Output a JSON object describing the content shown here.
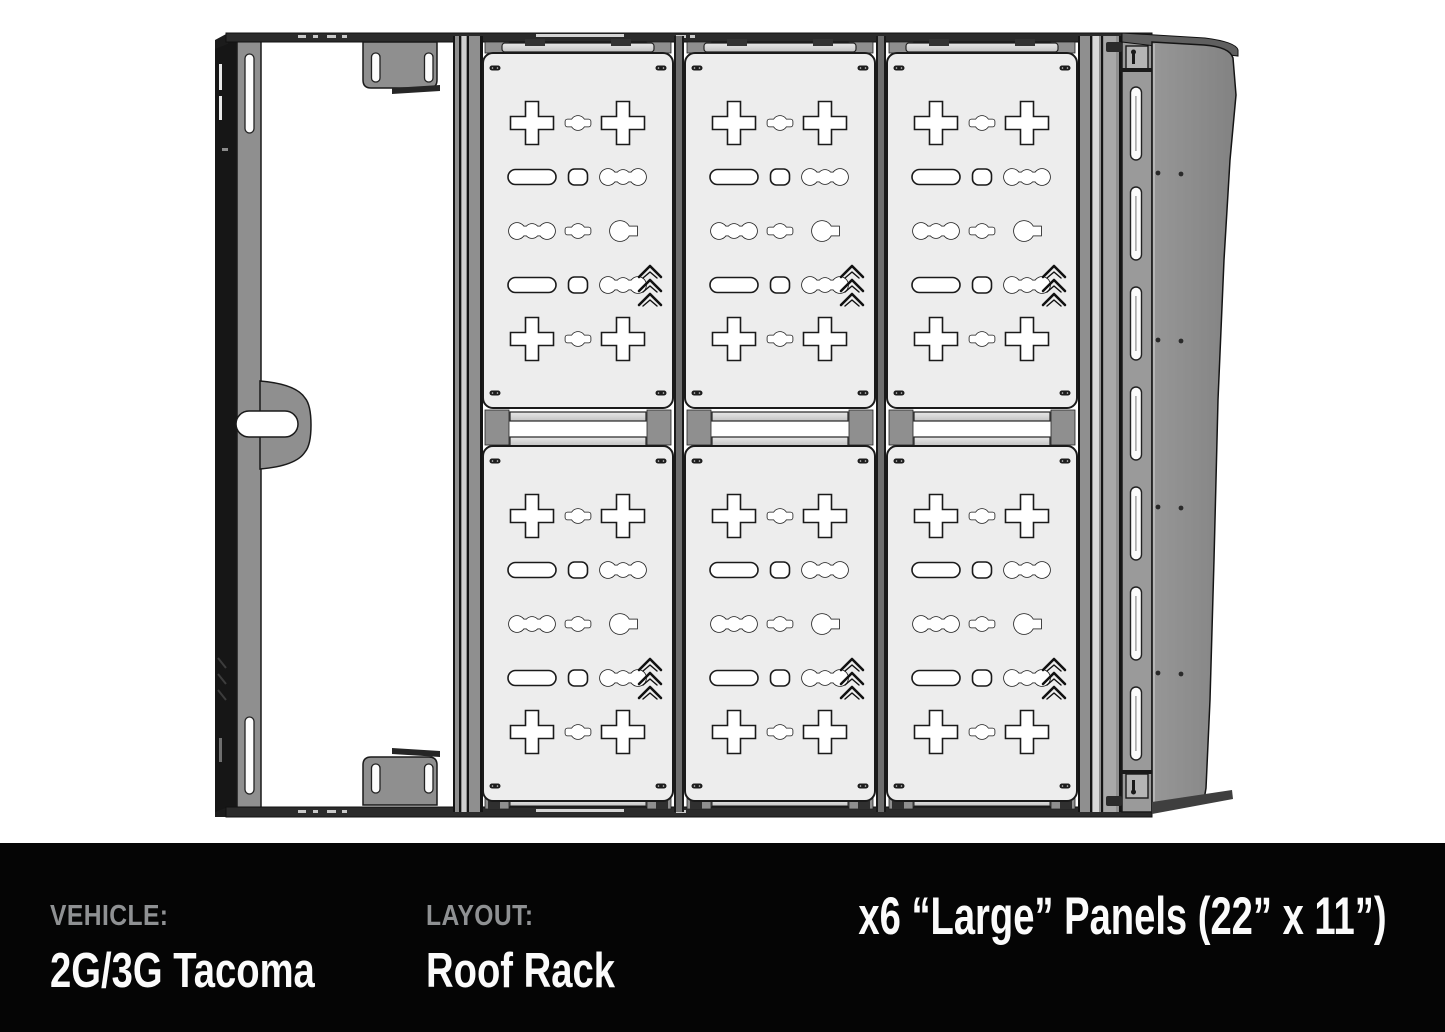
{
  "caption_bar": {
    "vehicle_label": "VEHICLE:",
    "vehicle_value": "2G/3G Tacoma",
    "layout_label": "LAYOUT:",
    "layout_value": "Roof Rack",
    "panels_note": "x6 “Large” Panels (22” x 11”)"
  },
  "diagram": {
    "panel_grid": {
      "rows": 2,
      "cols": 3,
      "total_panels": 6
    },
    "panel_cutout_pattern": [
      [
        "plus",
        "pinch",
        "plus"
      ],
      [
        "pill",
        "sqr",
        "bone"
      ],
      [
        "bone",
        "pinch",
        "keyhole"
      ],
      [
        "pill",
        "sqr",
        "bone"
      ],
      [
        "plus",
        "pinch",
        "plus"
      ]
    ],
    "panel_logo": "triple-chevron-logo",
    "right_rail_slot_count": 7,
    "colors": {
      "panel_fill": "#ededed",
      "rail_gray": "#8f8f8f",
      "fairing_gray": "#8d8d8d",
      "outline": "#1a1a1a",
      "bar_dark": "#2b2b2b",
      "caption_bg": "#050505",
      "caption_label": "#8f9193",
      "caption_text": "#fbfbfb"
    }
  }
}
